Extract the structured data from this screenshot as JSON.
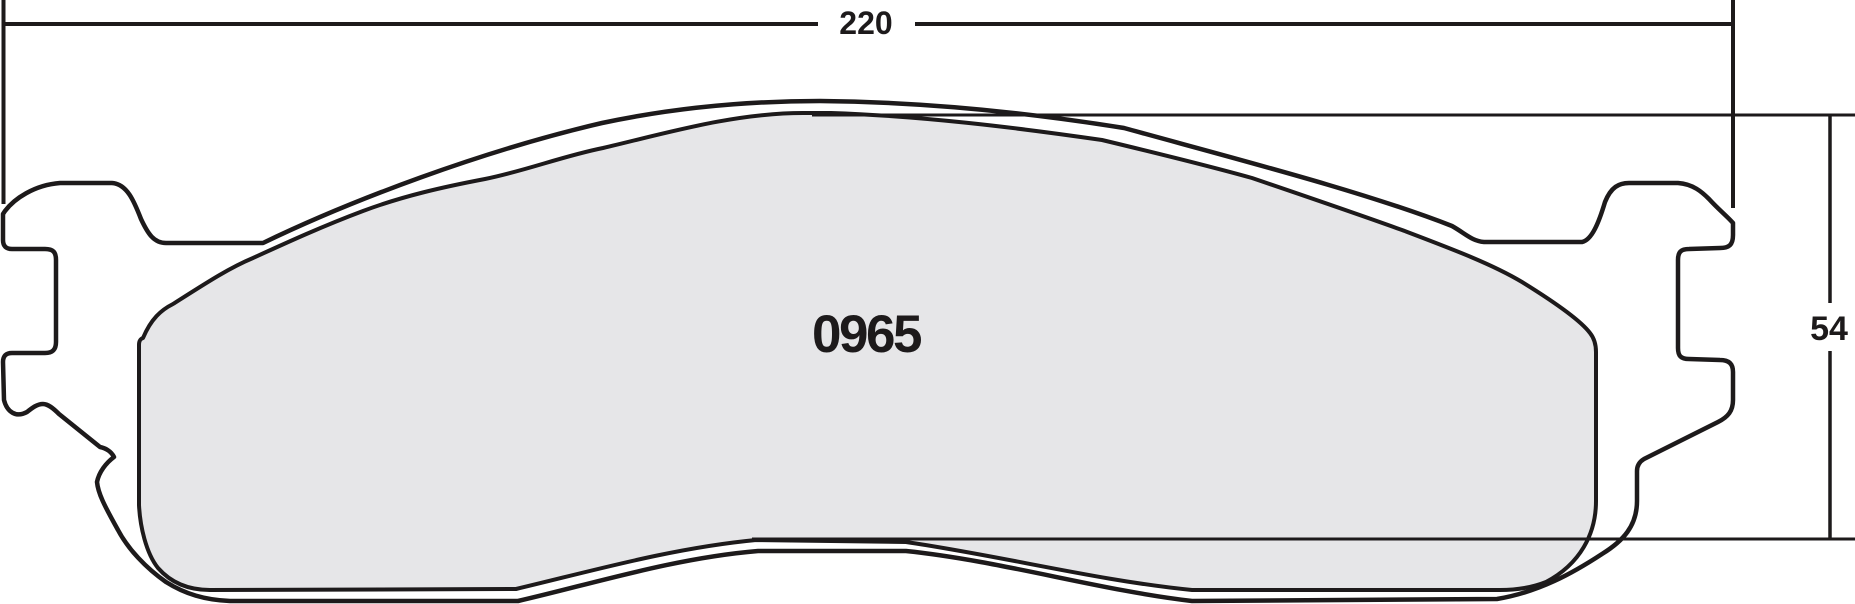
{
  "drawing": {
    "type": "brake-pad-dimensional-drawing",
    "part_number": "0965",
    "dimensions": {
      "width": {
        "label": "220",
        "value_mm": 220,
        "orientation": "horizontal"
      },
      "height": {
        "label": "54",
        "value_mm": 54,
        "orientation": "vertical"
      }
    },
    "regions": {
      "friction_material": "gray filled pad surface",
      "backing_plate": "white outlined plate with abutment ears"
    },
    "colors": {
      "line": "#1d1a1b",
      "friction_fill": "#e6e6e8",
      "background": "#ffffff"
    }
  }
}
